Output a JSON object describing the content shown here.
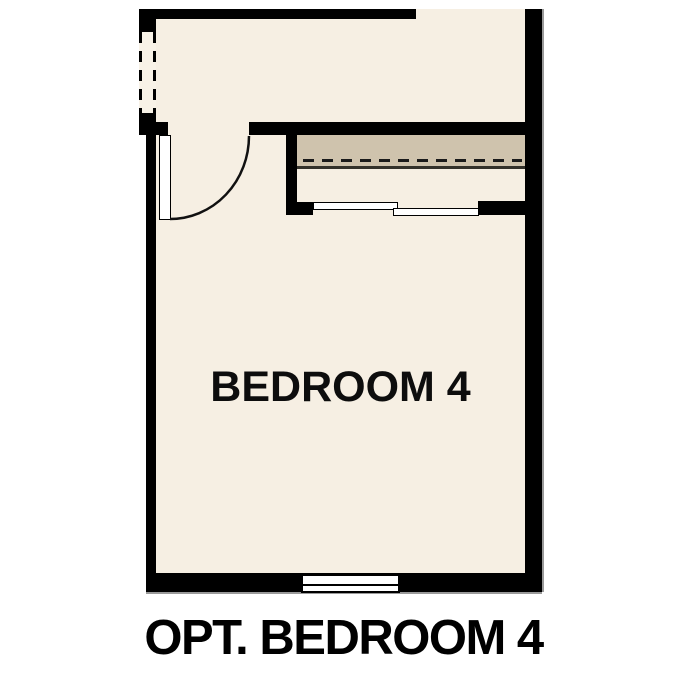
{
  "plan": {
    "room_label": "BEDROOM 4",
    "caption": "OPT. BEDROOM 4",
    "colors": {
      "background": "#ffffff",
      "wall": "#000000",
      "floor": "#f6efe3",
      "closet_shelf": "#cfc3ad",
      "symbol_fill": "#ffffff",
      "edge_shadow": "#9a9a9a"
    },
    "symbols": {
      "door": "swing-door-with-arc",
      "left_opening": "cased-opening-dashed",
      "closet": "shelf-with-hanging-rod",
      "closet_doors": "bypass-sliding-panels",
      "window": "double-line-window"
    }
  }
}
